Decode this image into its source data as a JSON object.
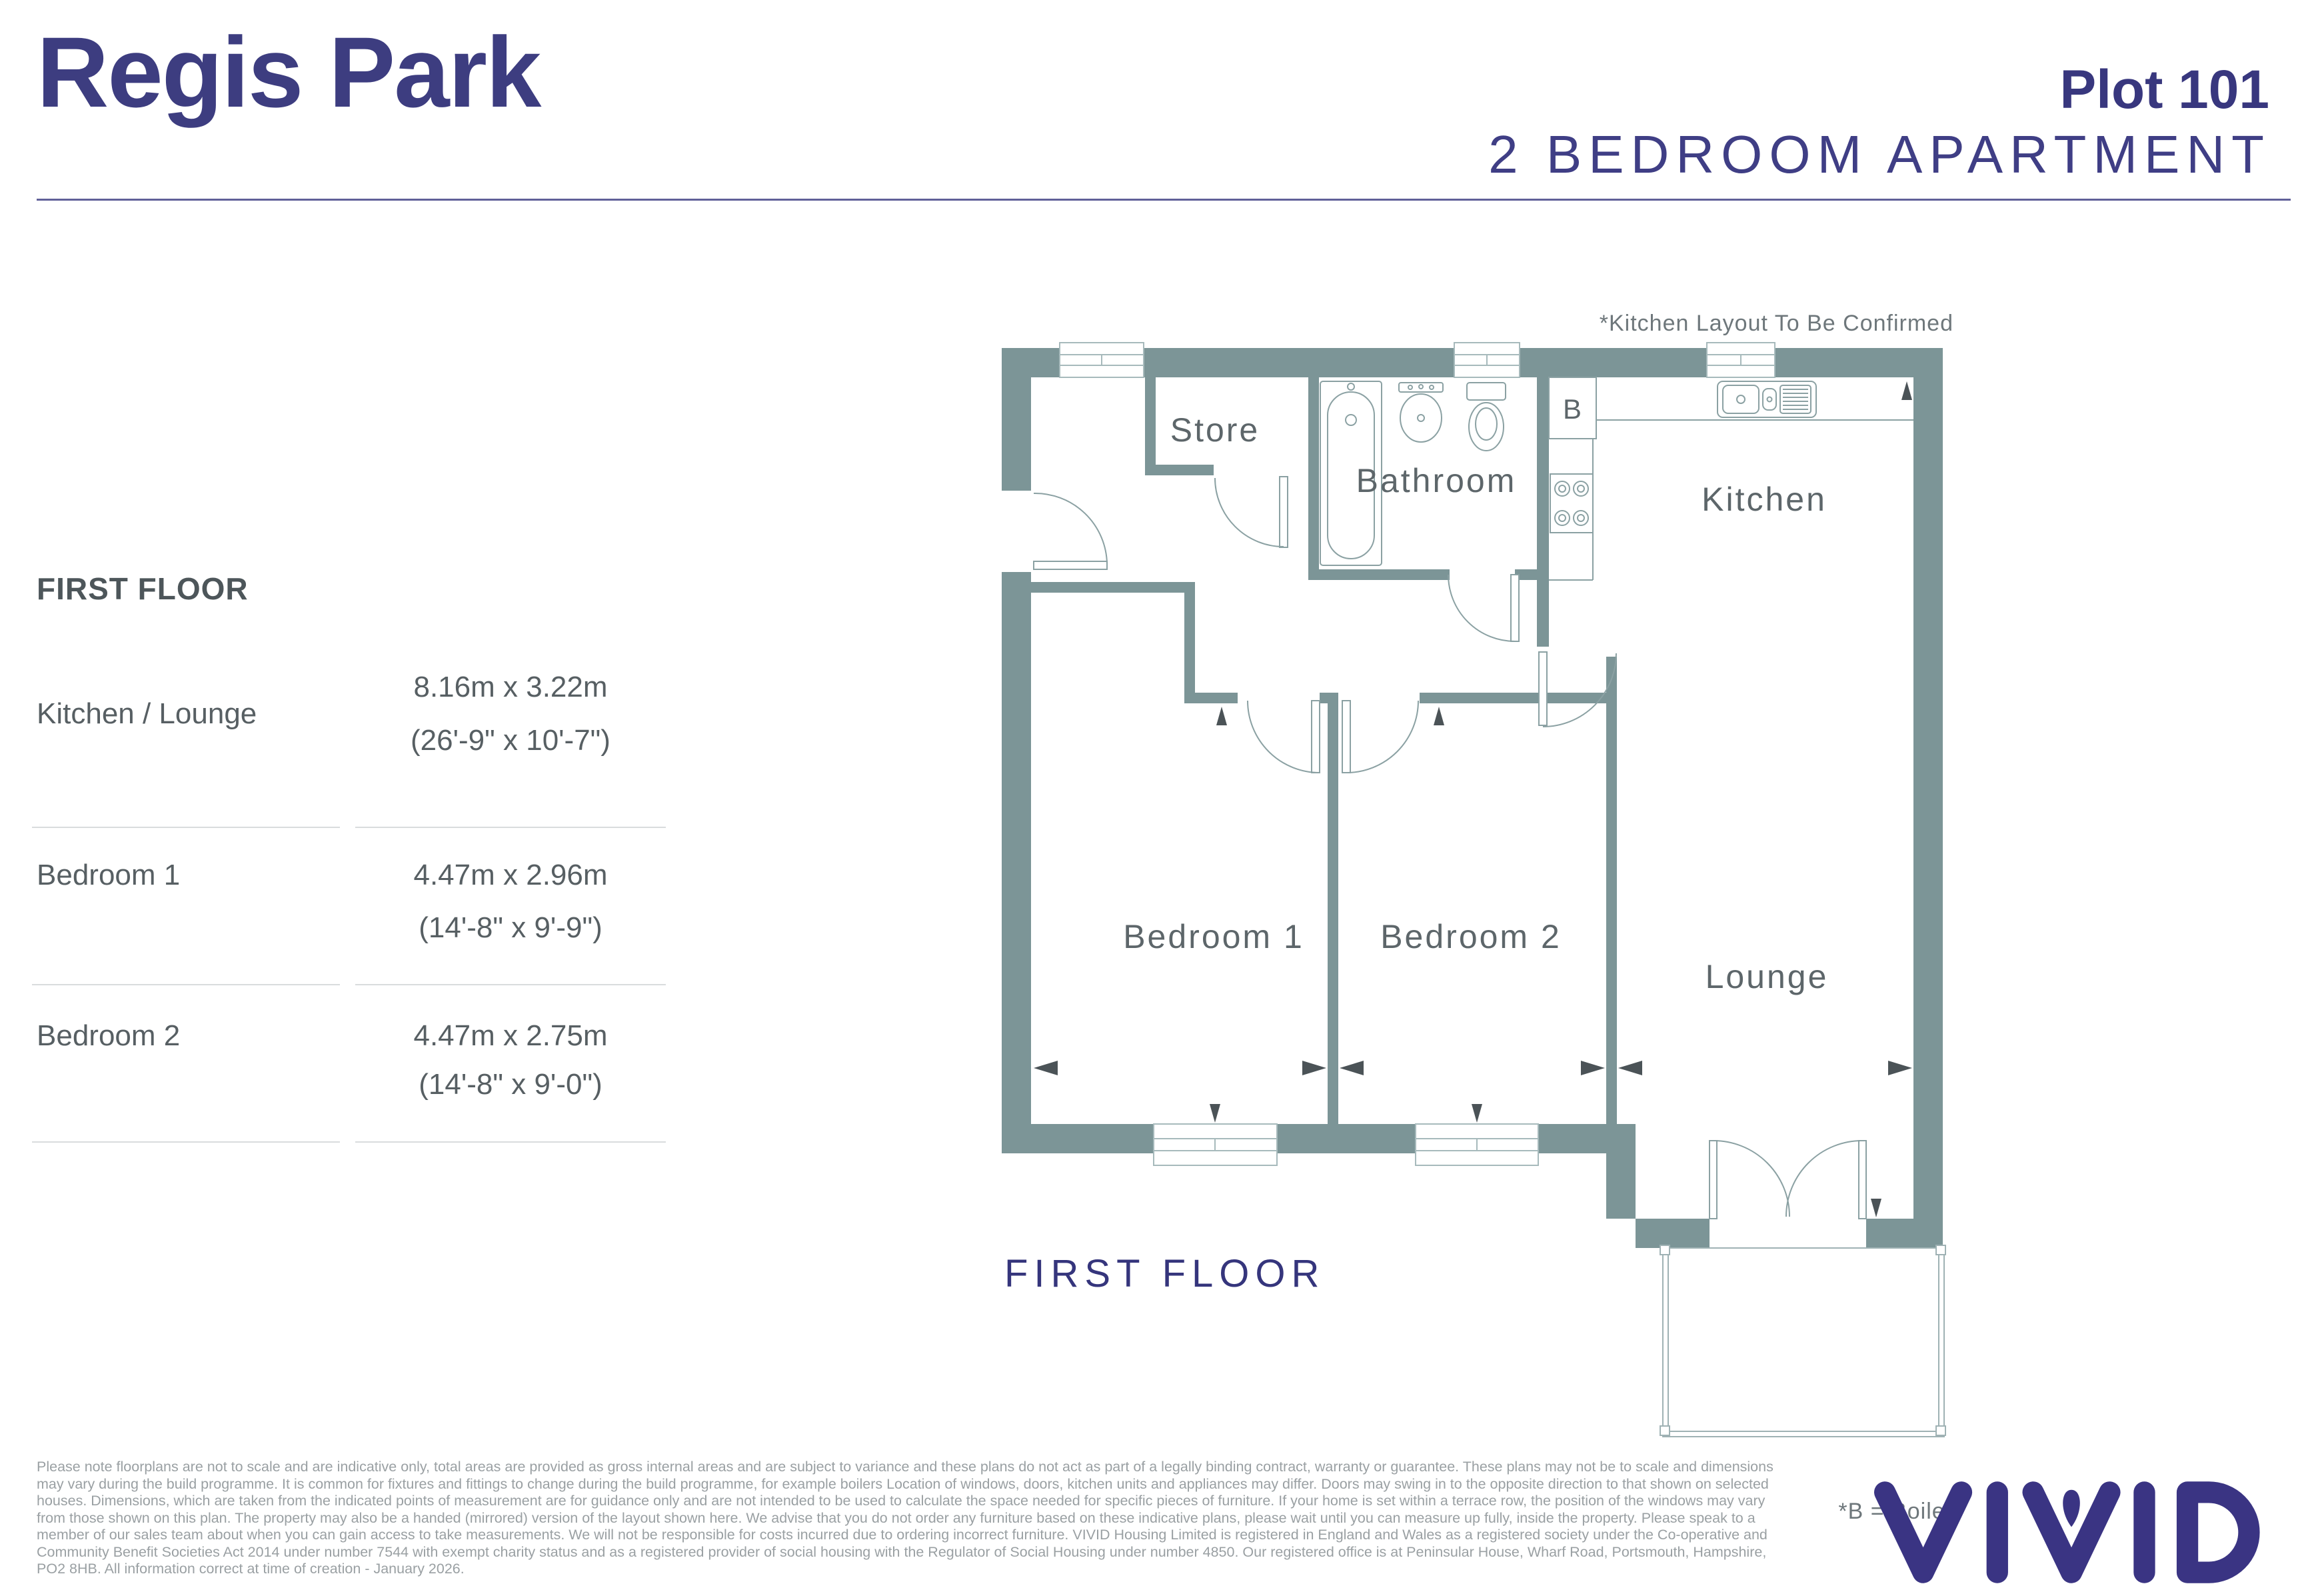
{
  "header": {
    "development": "Regis Park",
    "plot": "Plot 101",
    "property_type": "2 BEDROOM APARTMENT"
  },
  "table": {
    "title": "FIRST FLOOR",
    "rows": [
      {
        "room": "Kitchen / Lounge",
        "metric": "8.16m x 3.22m",
        "imperial": "(26'-9\" x 10'-7\")"
      },
      {
        "room": "Bedroom 1",
        "metric": "4.47m x 2.96m",
        "imperial": "(14'-8\" x 9'-9\")"
      },
      {
        "room": "Bedroom 2",
        "metric": "4.47m x 2.75m",
        "imperial": "(14'-8\" x 9'-0\")"
      }
    ]
  },
  "plan": {
    "kitchen_note": "*Kitchen Layout To Be Confirmed",
    "floor_label": "FIRST FLOOR",
    "boiler_note": "*B = Boiler",
    "boiler_symbol": "B",
    "rooms": {
      "store": "Store",
      "bathroom": "Bathroom",
      "kitchen": "Kitchen",
      "bedroom1": "Bedroom 1",
      "bedroom2": "Bedroom 2",
      "lounge": "Lounge"
    }
  },
  "disclaimer": "Please note floorplans are not to scale and are indicative only, total areas are provided as gross internal areas and are subject to variance and these plans do not act as part of a legally binding contract, warranty or guarantee. These plans may not be to scale and dimensions may vary during the build programme. It is common for fixtures and fittings to change during the build programme, for example boilers Location of windows, doors, kitchen units and appliances may differ. Doors may swing in to the opposite direction to that shown on selected houses. Dimensions, which are taken from the indicated points of measurement are for guidance only and are not intended to be used to calculate the space needed for specific pieces of furniture. If your home is set within a terrace row, the position of the windows may vary from those shown on this plan. The property may also be a handed (mirrored) version of the layout shown here. We advise that you do not order any furniture based on these indicative plans, please wait until you can measure up fully, inside the property. Please speak to a member of our sales team about when you can gain access to take measurements. We will not be responsible for costs incurred due to ordering incorrect furniture. VIVID Housing Limited is registered in England and Wales as a registered society under the Co-operative and Community Benefit Societies Act 2014 under number 7544 with exempt charity status and as a registered provider of social housing with the Regulator of Social Housing under number 4850. Our registered office is at Peninsular House, Wharf Road, Portsmouth, Hampshire, PO2 8HB. All information correct at time of creation - January 2026.",
  "brand": {
    "name": "VIVID"
  },
  "colors": {
    "navy": "#3a3a80",
    "wall": "#7c9597",
    "fixture_line": "#8ba1a3",
    "window_frame": "#a7babc",
    "room_label": "#5d666a",
    "note_text": "#6e777b",
    "table_text": "#575f63",
    "divider": "#d9dcdd",
    "disclaimer_text": "#9aa0a3",
    "logo": "#3a3483",
    "arrow": "#4b5357"
  }
}
